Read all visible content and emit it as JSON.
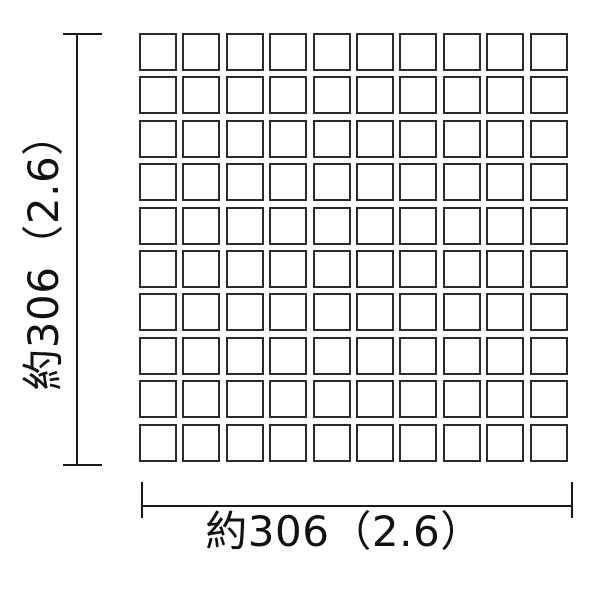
{
  "diagram": {
    "grid": {
      "rows": 10,
      "cols": 10,
      "tile_shape": "square"
    },
    "dimensions": {
      "height_label": "約306（2.6）",
      "width_label": "約306（2.6）",
      "height_primary_value": 306,
      "height_secondary_value": 2.6,
      "width_primary_value": 306,
      "width_secondary_value": 2.6,
      "approx_prefix": "約"
    },
    "theme": {
      "background": "#ffffff",
      "line_color": "#1a1a1a",
      "tile_border_color": "#2b2b2b",
      "tile_fill": "#ffffff",
      "text_color": "#111111"
    }
  }
}
